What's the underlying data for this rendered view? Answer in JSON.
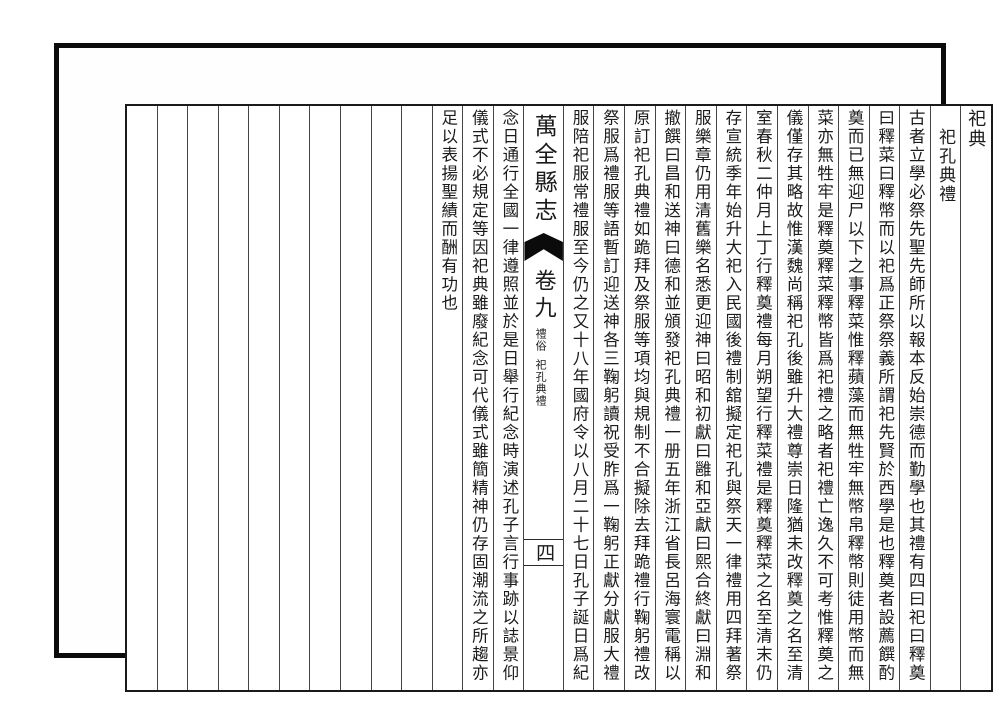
{
  "book": {
    "margin_label": "祀典",
    "section_title": "祀孔典禮",
    "body_columns_right": [
      "古者立學必祭先聖先師所以報本反始崇德而勤學也其禮有四曰祀曰釋奠",
      "曰釋菜曰釋幣而以祀爲正祭祭義所謂祀先賢於西學是也釋奠者設薦饌酌",
      "奠而已無迎尸以下之事釋菜惟釋蘋藻而無牲牢無幣帛釋幣則徒用幣而無",
      "菜亦無牲牢是釋奠釋菜釋幣皆爲祀禮之略者祀禮亡逸久不可考惟釋奠之",
      "儀僅存其略故惟漢魏尚稱祀孔後雖升大禮尊崇日隆猶未改釋奠之名至清",
      "室春秋二仲月上丁行釋奠禮每月朔望行釋菜禮是釋奠釋菜之名至清末仍",
      "存宣統季年始升大祀入民國後禮制舘擬定祀孔與祭天一律禮用四拜著祭",
      "服樂章仍用清舊樂名悉更迎神曰昭和初獻曰雝和亞獻曰熙合終獻曰淵和",
      "撤饌曰昌和送神曰德和並頒發祀孔典禮一册五年浙江省長呂海寰電稱以",
      "原訂祀孔典禮如跪拜及祭服等項均與規制不合擬除去拜跪禮行鞠躬禮改",
      "祭服爲禮服等語暫訂迎送神各三鞠躬讀祝受胙爲一鞠躬正獻分獻服大禮",
      "服陪祀服常禮服至今仍之又十八年國府令以八月二十七日孔子誕日爲紀"
    ],
    "body_columns_left": [
      "念日通行全國一律遵照並於是日舉行紀念時演述孔子言行事跡以誌景仰",
      "儀式不必規定等因祀典雖廢紀念可代儀式雖簡精神仍存固潮流之所趨亦",
      "足以表揚聖績而酬有功也"
    ],
    "banxin": {
      "book_title": "萬全縣志",
      "volume": "卷九",
      "section": "禮俗",
      "subsection": "祀孔典禮",
      "page_number": "四"
    }
  },
  "colors": {
    "ink": "#1b1b1b",
    "paper": "#ffffff",
    "frame": "#0b0b0b",
    "rule_line": "#454545"
  }
}
